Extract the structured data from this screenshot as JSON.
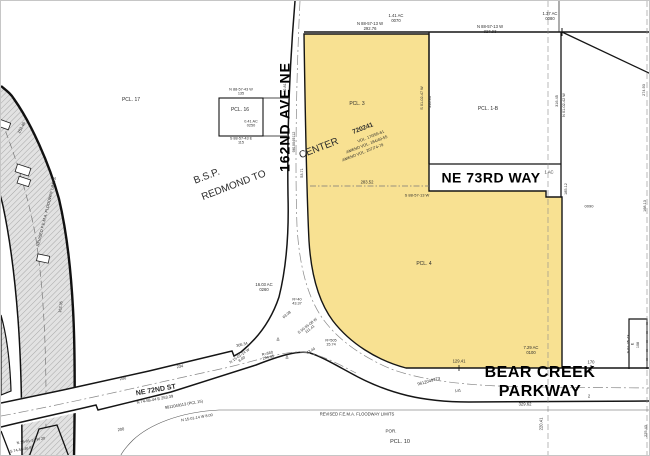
{
  "map": {
    "type": "assessor-plat-map",
    "background": "#ffffff",
    "line_color": "#151515",
    "highlight_fill": "#f8e192",
    "plat_name": "B.S.P. REDMOND TOWN CENTER 720241",
    "streets": [
      "162ND AVE NE",
      "NE 73RD WAY",
      "BEAR CREEK PARKWAY",
      "NE 72ND ST"
    ],
    "parcels": [
      "PCL. 17",
      "PCL. 16",
      "PCL. 3",
      "PCL. 4",
      "PCL. 1-B",
      "PCL. 10"
    ],
    "highlighted_parcel": {
      "labels": [
        "PCL. 3",
        "PCL. 4"
      ],
      "area": "7.29 AC",
      "lot": "0100"
    }
  },
  "labels": [
    {
      "n": "street-label-162nd-ave-ne",
      "t": "162ND AVE NE",
      "x": 284,
      "y": 116,
      "r": -90,
      "s": 14,
      "b": 1,
      "ls": 1,
      "c": "#000"
    },
    {
      "n": "street-label-ne-73rd-way",
      "t": "NE 73RD WAY",
      "x": 490,
      "y": 177,
      "r": 0,
      "s": 14,
      "b": 1,
      "ls": 0.5,
      "c": "#000"
    },
    {
      "n": "street-label-bear-creek-parkway",
      "t": "BEAR CREEK PARKWAY",
      "x": 539,
      "y": 382,
      "r": 0,
      "s": 16,
      "b": 1,
      "ls": 0.5,
      "c": "#000"
    },
    {
      "n": "street-label-ne-72nd-st",
      "t": "NE 72ND ST",
      "x": 155,
      "y": 390,
      "r": -10,
      "s": 7,
      "b": 1
    },
    {
      "n": "plat-label-bsp",
      "t": "B.S.P.",
      "x": 206,
      "y": 176,
      "r": -21,
      "s": 10
    },
    {
      "n": "plat-label-redmond-to",
      "t": "REDMOND TO",
      "x": 233,
      "y": 185,
      "r": -21,
      "s": 10
    },
    {
      "n": "plat-label-center",
      "t": "CENTER",
      "x": 318,
      "y": 148,
      "r": -21,
      "s": 10
    },
    {
      "n": "plat-label-number",
      "t": "720241",
      "x": 362,
      "y": 128,
      "r": -21,
      "s": 6.5,
      "b": 1
    },
    {
      "n": "plat-label-vol",
      "t": "VOL. 170/55-61",
      "x": 370,
      "y": 136,
      "r": -21,
      "s": 4
    },
    {
      "n": "plat-label-amend1",
      "t": "AMEND VOL. 184/49-55",
      "x": 366,
      "y": 144,
      "r": -21,
      "s": 4
    },
    {
      "n": "plat-label-amend2",
      "t": "AMEND VOL. 207/74-79",
      "x": 362,
      "y": 152,
      "r": -21,
      "s": 4
    },
    {
      "n": "parcel-label-17",
      "t": "PCL. 17",
      "x": 130,
      "y": 100,
      "s": 5
    },
    {
      "n": "parcel-label-16",
      "t": "PCL. 16",
      "x": 239,
      "y": 110,
      "s": 5
    },
    {
      "n": "parcel-label-3",
      "t": "PCL. 3",
      "x": 356,
      "y": 104,
      "s": 5
    },
    {
      "n": "parcel-label-4",
      "t": "PCL. 4",
      "x": 423,
      "y": 264,
      "s": 5
    },
    {
      "n": "parcel-label-1b",
      "t": "PCL. 1-B",
      "x": 487,
      "y": 109,
      "s": 5
    },
    {
      "n": "parcel-label-10",
      "t": "PCL. 10",
      "x": 399,
      "y": 441,
      "s": 5.5
    },
    {
      "n": "parcel-label-por",
      "t": "POR.",
      "x": 390,
      "y": 430,
      "s": 4.5
    },
    {
      "n": "lot-0070",
      "t": "1.41 AC\n0070",
      "x": 395,
      "y": 18,
      "s": 4.2
    },
    {
      "n": "lot-0080",
      "t": "1.37 AC\n0080",
      "x": 549,
      "y": 16,
      "s": 4.2
    },
    {
      "n": "lot-0090",
      "t": "0090",
      "x": 588,
      "y": 206,
      "s": 4
    },
    {
      "n": "lot-0260",
      "t": "16.03 AC\n0260",
      "x": 263,
      "y": 287,
      "s": 4.2
    },
    {
      "n": "lot-0100",
      "t": "7.29 AC\n0100",
      "x": 530,
      "y": 350,
      "s": 4.2
    },
    {
      "n": "lot-0250",
      "t": "0.41 AC\n0250",
      "x": 250,
      "y": 123,
      "s": 3.8
    },
    {
      "n": "lot-1ac",
      "t": "1 AC",
      "x": 548,
      "y": 172,
      "s": 4.2
    },
    {
      "n": "dim-top-left",
      "t": "N 88-57-13 W\n292.76",
      "x": 369,
      "y": 26,
      "s": 4.2
    },
    {
      "n": "dim-top-right",
      "t": "N 88-57-13 W\n327.93",
      "x": 489,
      "y": 29,
      "s": 4.2
    },
    {
      "n": "dim-pcl16-top",
      "t": "N 88-57-43 W\n135",
      "x": 240,
      "y": 91,
      "s": 3.8
    },
    {
      "n": "dim-pcl16-bottom",
      "t": "S 88-57-43 E\n115",
      "x": 240,
      "y": 140,
      "s": 3.8
    },
    {
      "n": "dim-283-52",
      "t": "283.52",
      "x": 366,
      "y": 182,
      "s": 4.2
    },
    {
      "n": "dim-s885713w",
      "t": "S 88-57-13 W",
      "x": 416,
      "y": 195,
      "s": 4
    },
    {
      "n": "dim-129-41",
      "t": "129.41",
      "x": 458,
      "y": 361,
      "s": 4.2
    },
    {
      "n": "dim-170",
      "t": "170",
      "x": 590,
      "y": 362,
      "s": 4.2
    },
    {
      "n": "dim-329-62",
      "t": "329.62",
      "x": 524,
      "y": 404,
      "s": 4.2
    },
    {
      "n": "dim-220-41",
      "t": "220.41",
      "x": 541,
      "y": 423,
      "r": -90,
      "s": 4.2
    },
    {
      "n": "fema-label-bottom",
      "t": "REVISED F.E.M.A. FLOODWAY LIMITS",
      "x": 356,
      "y": 414,
      "s": 4.2
    },
    {
      "n": "rec-9612049773",
      "t": "9612049773",
      "x": 428,
      "y": 381,
      "r": -15,
      "s": 4.2
    },
    {
      "n": "rec-9811049113",
      "t": "9811049113   (PCL 15)",
      "x": 183,
      "y": 404,
      "r": -10,
      "s": 4
    },
    {
      "n": "dim-253-39",
      "t": "N 74-58-44 E    253.39",
      "x": 154,
      "y": 399,
      "r": -10,
      "s": 4
    },
    {
      "n": "dim-200a",
      "t": "200",
      "x": 122,
      "y": 378,
      "r": -10,
      "s": 4
    },
    {
      "n": "dim-200b",
      "t": "200",
      "x": 120,
      "y": 429,
      "r": -10,
      "s": 4
    },
    {
      "n": "dim-234",
      "t": "234",
      "x": 179,
      "y": 366,
      "r": -10,
      "s": 4
    },
    {
      "n": "dim-jog-north",
      "t": "N 15-01-14 W\n8.00",
      "x": 240,
      "y": 357,
      "r": -35,
      "s": 3.8
    },
    {
      "n": "dim-jog-south",
      "t": "N 15-01-14 W  8.00",
      "x": 196,
      "y": 417,
      "r": -10,
      "s": 3.8
    },
    {
      "n": "dim-bl-1",
      "t": "N 15-01-14 W   20",
      "x": 30,
      "y": 440,
      "r": -10,
      "s": 3.8
    },
    {
      "n": "dim-bl-2",
      "t": "S 74-58-46 E",
      "x": 20,
      "y": 449,
      "r": -10,
      "s": 3.8
    },
    {
      "n": "dim-r40",
      "t": "R=40\n43.37",
      "x": 296,
      "y": 301,
      "s": 3.8
    },
    {
      "n": "dim-63-08",
      "t": "63.08",
      "x": 286,
      "y": 314,
      "r": -40,
      "s": 3.8
    },
    {
      "n": "dim-s505508w",
      "t": "S 50-55-08 W\n111.41",
      "x": 308,
      "y": 327,
      "r": -38,
      "s": 3.8
    },
    {
      "n": "dim-305-34",
      "t": "305.34",
      "x": 241,
      "y": 344,
      "r": -13,
      "s": 3.8
    },
    {
      "n": "dim-r560",
      "t": "R=560\n294.45",
      "x": 267,
      "y": 355,
      "r": -13,
      "s": 3.8
    },
    {
      "n": "delta-1",
      "t": "Δ",
      "x": 277,
      "y": 338,
      "s": 4.5
    },
    {
      "n": "delta-2",
      "t": "Δ",
      "x": 286,
      "y": 356,
      "s": 4.5
    },
    {
      "n": "dim-43-44",
      "t": "43.44",
      "x": 310,
      "y": 350,
      "r": -30,
      "s": 3.8
    },
    {
      "n": "dim-r505",
      "t": "R=505\n15.74",
      "x": 330,
      "y": 342,
      "s": 3.8
    },
    {
      "n": "dim-152-46",
      "t": "152.46",
      "x": 21,
      "y": 127,
      "r": -62,
      "s": 4
    },
    {
      "n": "fema-label-curve",
      "t": "REVISED F.E.M.A. FLOODWAY LIMITS",
      "x": 46,
      "y": 211,
      "r": -76,
      "s": 4
    },
    {
      "n": "dim-162-35",
      "t": "162.35",
      "x": 60,
      "y": 306,
      "r": -82,
      "s": 3.8
    },
    {
      "n": "dim-42-81",
      "t": "42.81",
      "x": 284,
      "y": 87,
      "r": -90,
      "s": 3.8
    },
    {
      "n": "rec-9810049112",
      "t": "9810049112",
      "x": 293,
      "y": 141,
      "r": -90,
      "s": 3.8
    },
    {
      "n": "dim-s010247w",
      "t": "S 01-02-47 W",
      "x": 421,
      "y": 97,
      "r": -90,
      "s": 3.8
    },
    {
      "n": "dim-316-93",
      "t": "316.93",
      "x": 429,
      "y": 101,
      "r": -90,
      "s": 3.8
    },
    {
      "n": "dim-316-45",
      "t": "316.45",
      "x": 556,
      "y": 100,
      "r": -90,
      "s": 3.8
    },
    {
      "n": "dim-n010242w",
      "t": "N 01-02-42 W",
      "x": 563,
      "y": 104,
      "r": -90,
      "s": 3.8
    },
    {
      "n": "dim-185-12",
      "t": "185.12",
      "x": 565,
      "y": 188,
      "r": -90,
      "s": 3.8
    },
    {
      "n": "dim-53-71",
      "t": "53.71",
      "x": 301,
      "y": 172,
      "r": -90,
      "s": 3.8
    },
    {
      "n": "dim-274-93",
      "t": "274.93",
      "x": 643,
      "y": 89,
      "r": -90,
      "s": 3.8
    },
    {
      "n": "dim-168-13",
      "t": "168.13",
      "x": 644,
      "y": 205,
      "r": -90,
      "s": 3.8
    },
    {
      "n": "dim-225-43",
      "t": "225.43",
      "x": 645,
      "y": 430,
      "r": -90,
      "s": 3.8
    },
    {
      "n": "dim-box-bearing",
      "t": "S 01-25-43 E",
      "x": 630,
      "y": 343,
      "r": -90,
      "s": 3.8
    },
    {
      "n": "dim-box-108",
      "t": "108",
      "x": 637,
      "y": 344,
      "r": -90,
      "s": 3.8
    },
    {
      "n": "sta-2a",
      "t": "2",
      "x": 500,
      "y": 392,
      "s": 4.2
    },
    {
      "n": "sta-2b",
      "t": "2",
      "x": 588,
      "y": 396,
      "s": 4.2
    },
    {
      "n": "dim-141",
      "t": "141",
      "x": 457,
      "y": 390,
      "r": -10,
      "s": 3.8
    }
  ]
}
